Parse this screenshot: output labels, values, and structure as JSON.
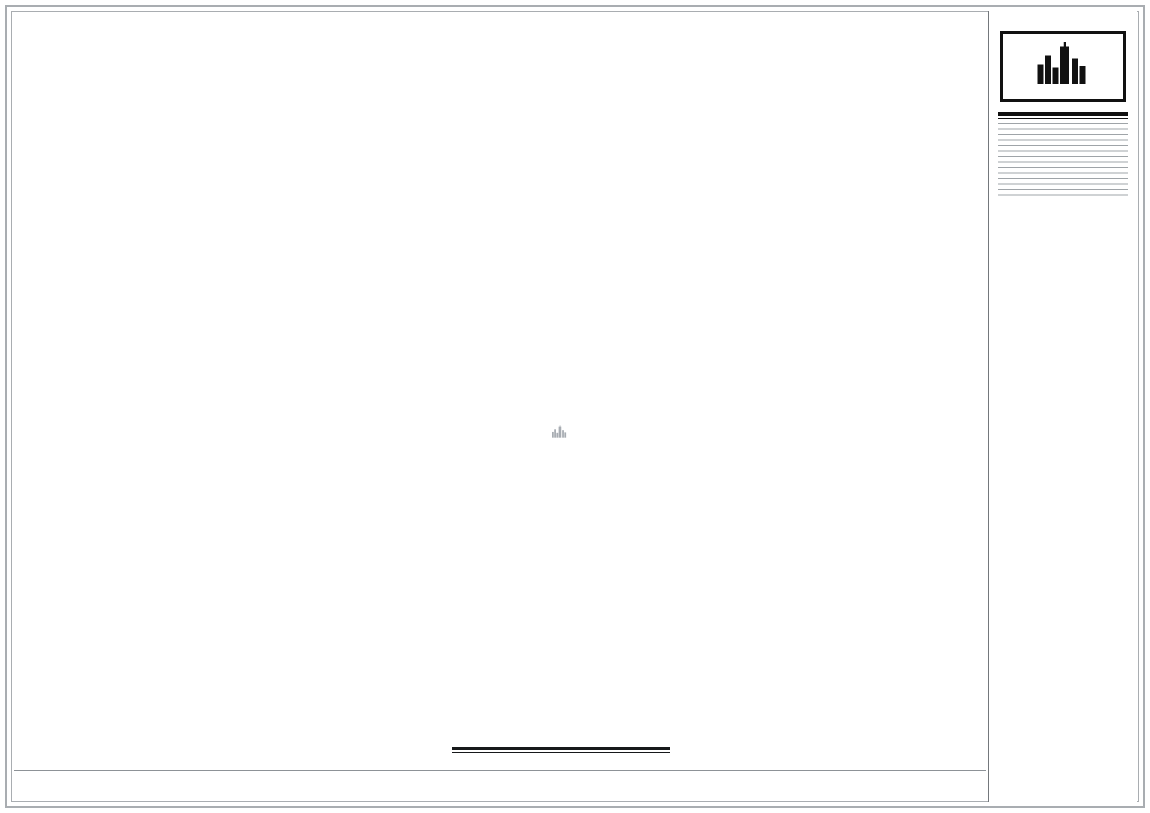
{
  "sheet": {
    "units_note": "单位:毫米 (mm)",
    "caption": {
      "title": "平面布置图",
      "scale": "1:65",
      "note": "注: 本图标高±0.000为装修完成地面标高.",
      "area_label": "面积：171m²"
    }
  },
  "titleblock": {
    "logo": {
      "name_en": "MOKCHUEN",
      "name_cn": "莫川建筑空间设计"
    },
    "fields": [
      {
        "label_en": "PROJECT",
        "label_cn": "项目名称",
        "value": "信义荔山公馆",
        "signature": false
      },
      {
        "label_en": "DRAWING TITLE",
        "label_cn": "图纸名称",
        "value": "平面布置图",
        "signature": false
      },
      {
        "label_en": "GENERAL DESIGNED",
        "label_cn": "总设计",
        "value": "",
        "signature": true
      },
      {
        "label_en": "EXAMINATION",
        "label_cn": "审核",
        "value": "",
        "signature": true
      },
      {
        "label_en": "APPROVED",
        "label_cn": "审定",
        "value": "高军",
        "signature": false
      },
      {
        "label_en": "DESIGN DEVELOPMENT",
        "label_cn": "深化设计",
        "value": "",
        "signature": true
      },
      {
        "label_en": "DRAWING",
        "label_cn": "制图",
        "value": "",
        "signature": true
      },
      {
        "label_en": "CHECKED",
        "label_cn": "校对",
        "value": "",
        "signature": true
      },
      {
        "label_en": "DRAWING NO.",
        "label_cn": "图纸编号",
        "value": "P-04",
        "signature": false
      },
      {
        "label_en": "SCALE",
        "label_cn": "比例",
        "value": "A3/1:65",
        "signature": false
      },
      {
        "label_en": "DATE",
        "label_cn": "日期",
        "value": "2020年07月06日",
        "signature": false
      },
      {
        "label_en": "Client approved",
        "label_cn": "业主认可",
        "value": "",
        "signature": false
      },
      {
        "label_en": "Registration Stamp",
        "label_cn": "执业签章",
        "value": "",
        "signature": false
      },
      {
        "label_en": "REMARK",
        "label_cn": "备注",
        "value": "",
        "signature": false,
        "notes": [
          "1、本设计图纸中图形尺寸均以毫米为单位，标高以米为单位；",
          "2、施工时应严格按照施工图纸施工，局部小尺寸（50mm以内）可根据现场实况进行调整，若偏差较大必须请示设计师，由设计师处理。"
        ]
      },
      {
        "label_en": "Release Stamp",
        "label_cn": "出图签章",
        "value": "",
        "signature": false
      }
    ]
  },
  "plan": {
    "watermark": {
      "cn": "莫川建筑空间设计",
      "en": "MOKCHUEN BUILDING SPACE DESIGN"
    },
    "rooms": [
      {
        "name": "阳台",
        "s": "S:9.4m²",
        "m": "M:15.7m"
      },
      {
        "name": "父母房",
        "s": "S:16.8m²",
        "m": "M:18.0m"
      },
      {
        "name": "小孩房1",
        "s": "S:10.3m²",
        "m": "M:14.1m"
      },
      {
        "name": "小孩房2",
        "s": "S:10.6m²",
        "m": "M:14.2m"
      },
      {
        "name": "中厨",
        "s": "S:7.3m²",
        "m": "M:12.0m"
      },
      {
        "name": "客餐厅",
        "s": "S:32.9m²",
        "m": "M:26.6m"
      },
      {
        "name": "入户玄关",
        "s": "S:12.1m²",
        "m": "M:14.7m"
      },
      {
        "name": "楼梯间",
        "s": "S:8.7m²",
        "m": "M:10.5m"
      },
      {
        "name": "公卫",
        "s": "S:6.5m²",
        "m": "M:11.3m"
      },
      {
        "name": "主卫",
        "s": "S:7.9m²",
        "m": "M:12.3m"
      },
      {
        "name": "多功能房",
        "s": "S:9.7m²",
        "m": "M:12.9m"
      }
    ],
    "dims": {
      "top": {
        "total": "18050",
        "segments": [
          "640",
          "3525",
          "250",
          "2740",
          "585",
          "120",
          "2515",
          "290",
          "4295",
          "275",
          "1055",
          "300",
          "1460"
        ]
      },
      "bottom": {
        "total": "17340",
        "segments": [
          "2425",
          "180",
          "2735",
          "275",
          "2340",
          "170",
          "1610",
          "290",
          "3490",
          "360",
          "3465"
        ]
      },
      "left": {
        "total": "8720",
        "segments": [
          "660",
          "4300",
          "190",
          "1055",
          "1735",
          "780"
        ]
      },
      "right": {
        "total": "10055",
        "segments": [
          "3070",
          "190",
          "2525",
          "380",
          "3890"
        ]
      }
    },
    "colors": {
      "glazing": "#8aa4ba",
      "wood_deck": "#c8b693",
      "wall": "#26292d",
      "rug": "#4772a5",
      "symbol": "#f7f4cd"
    }
  }
}
